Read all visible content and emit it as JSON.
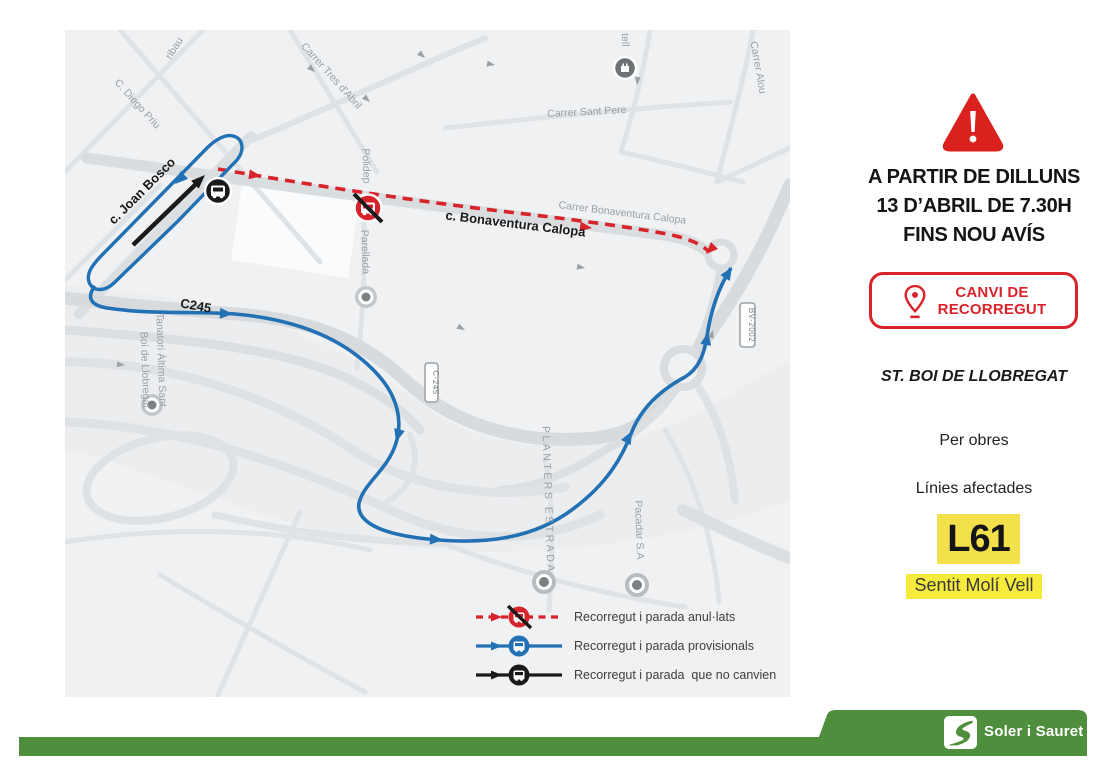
{
  "panel": {
    "title_lines": [
      "A PARTIR DE DILLUNS",
      "13 D’ABRIL DE 7.30H",
      "FINS NOU AVÍS"
    ],
    "badge": {
      "line1": "CANVI DE",
      "line2": "RECORREGUT"
    },
    "municipality": "ST. BOI DE LLOBREGAT",
    "reason": "Per obres",
    "affected_label": "Línies afectades",
    "line_code": "L61",
    "direction": "Sentit Molí Vell"
  },
  "legend": {
    "items": [
      {
        "name": "cancelled",
        "label": "Recorregut i parada anul·lats"
      },
      {
        "name": "provisional",
        "label": "Recorregut i parada provisionals"
      },
      {
        "name": "unchanged",
        "label": "Recorregut i parada  que no canvien"
      }
    ]
  },
  "map": {
    "labels": {
      "aribau": "ribau",
      "diego_priu": "C. Diego Priu",
      "joan_bosco": "c. Joan Bosco",
      "tres_abril": "Carrer Tres d'Abril",
      "sant_pere": "Carrer Sant Pere",
      "castell": "tell",
      "alou": "Carrer Alou",
      "polidep": "Polidep",
      "parellada": "Parellada",
      "bonaventura": "Carrer Bonaventura Calopa",
      "bonaventura_bold": "c. Bonaventura Calopa",
      "c245": "C245",
      "tanatori_1": "Tanatori Àltima Sant",
      "tanatori_2": "Boi de Llobregat",
      "planters": "PLANTERS ESTRADA",
      "pacadar": "Pacadar S.A",
      "shield_bv2002": "BV-2002",
      "shield_c245": "C-245"
    }
  },
  "footer": {
    "company": "Soler i Sauret"
  },
  "colors": {
    "route_cancelled": "#d8232a",
    "route_provisional": "#2271b5",
    "route_unchanged": "#1a1a1a",
    "line_badge_bg": "#f2e14a",
    "direction_bg": "#f6ea3c",
    "footer_green": "#4e8e3c"
  }
}
